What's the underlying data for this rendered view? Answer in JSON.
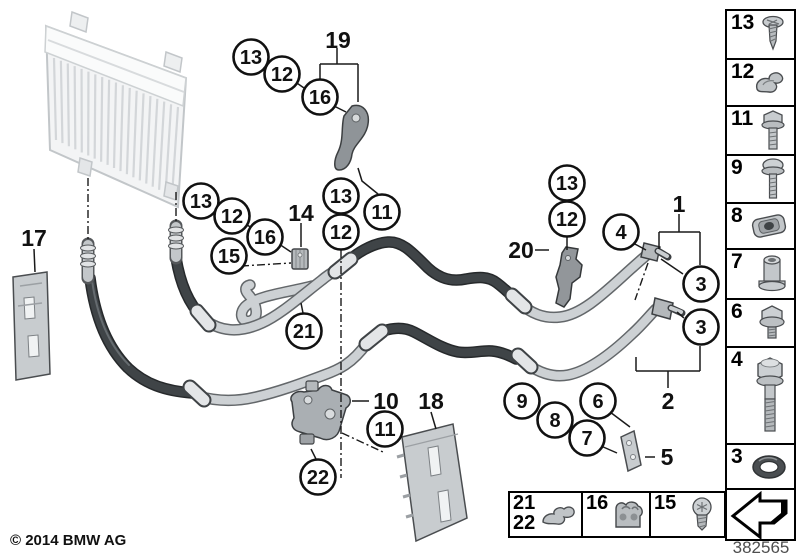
{
  "meta": {
    "copyright": "© 2014 BMW AG",
    "diagram_number": "382565"
  },
  "legend_column": {
    "cells": [
      {
        "label": "13",
        "part": "tapping-screw"
      },
      {
        "label": "12",
        "part": "pipe-clip"
      },
      {
        "label": "11",
        "part": "flange-bolt"
      },
      {
        "label": "9",
        "part": "collar-screw"
      },
      {
        "label": "8",
        "part": "cage-nut"
      },
      {
        "label": "7",
        "part": "spacer-sleeve"
      },
      {
        "label": "6",
        "part": "flange-screw"
      },
      {
        "label": "4",
        "part": "hex-bolt"
      },
      {
        "label": "3",
        "part": "o-ring"
      }
    ],
    "arrow": "direction-arrow"
  },
  "legend_row": {
    "cells": [
      {
        "labels": [
          "21",
          "22"
        ],
        "part": "line-clip"
      },
      {
        "label": "16",
        "part": "holder-clamp"
      },
      {
        "label": "15",
        "part": "pan-head-screw"
      }
    ]
  },
  "callouts": {
    "circled": [
      {
        "label": "13",
        "x": 251,
        "y": 57
      },
      {
        "label": "12",
        "x": 282,
        "y": 74
      },
      {
        "label": "16",
        "x": 320,
        "y": 97
      },
      {
        "label": "13",
        "x": 201,
        "y": 201
      },
      {
        "label": "12",
        "x": 232,
        "y": 216
      },
      {
        "label": "16",
        "x": 265,
        "y": 237
      },
      {
        "label": "15",
        "x": 229,
        "y": 256
      },
      {
        "label": "13",
        "x": 341,
        "y": 196
      },
      {
        "label": "12",
        "x": 341,
        "y": 232
      },
      {
        "label": "11",
        "x": 382,
        "y": 212
      },
      {
        "label": "21",
        "x": 304,
        "y": 331
      },
      {
        "label": "13",
        "x": 567,
        "y": 183
      },
      {
        "label": "12",
        "x": 567,
        "y": 219
      },
      {
        "label": "4",
        "x": 621,
        "y": 232
      },
      {
        "label": "3",
        "x": 701,
        "y": 284
      },
      {
        "label": "3",
        "x": 701,
        "y": 327
      },
      {
        "label": "9",
        "x": 522,
        "y": 401
      },
      {
        "label": "8",
        "x": 555,
        "y": 420
      },
      {
        "label": "6",
        "x": 598,
        "y": 401
      },
      {
        "label": "7",
        "x": 587,
        "y": 438
      },
      {
        "label": "11",
        "x": 385,
        "y": 429
      },
      {
        "label": "22",
        "x": 318,
        "y": 477
      }
    ],
    "plain": [
      {
        "label": "19",
        "x": 338,
        "y": 40
      },
      {
        "label": "14",
        "x": 301,
        "y": 213
      },
      {
        "label": "17",
        "x": 34,
        "y": 238
      },
      {
        "label": "20",
        "x": 521,
        "y": 250
      },
      {
        "label": "1",
        "x": 679,
        "y": 204
      },
      {
        "label": "2",
        "x": 668,
        "y": 401
      },
      {
        "label": "5",
        "x": 667,
        "y": 457
      },
      {
        "label": "10",
        "x": 386,
        "y": 401
      },
      {
        "label": "18",
        "x": 431,
        "y": 401
      }
    ]
  },
  "colors": {
    "metal": "#cdd1d4",
    "rubber": "#3f4447",
    "outline": "#111111",
    "plate": "#c8cccf"
  }
}
